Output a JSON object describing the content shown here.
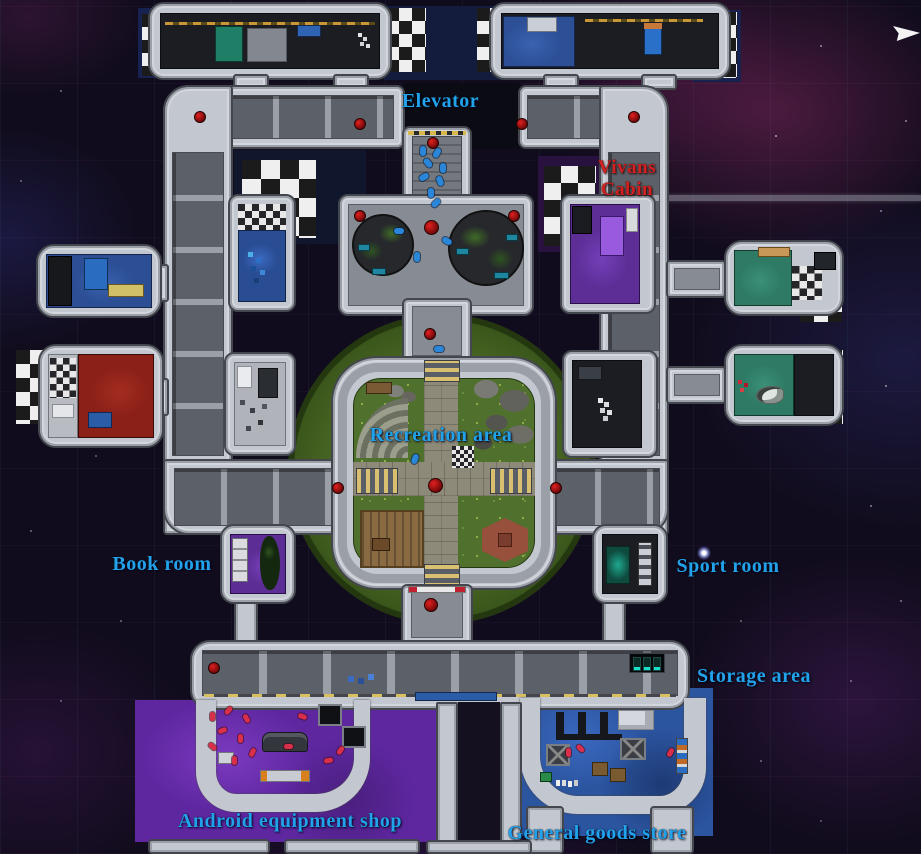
{
  "scene": {
    "description": "Top-down space station map with labeled rooms",
    "cursor_icon": "pointer-arrow-icon"
  },
  "labels": {
    "elevator": {
      "text": "Elevator",
      "color": "#22a2ea"
    },
    "vivans_cabin": {
      "line1": "Vivans",
      "line2": "Cabin",
      "color": "#d42020"
    },
    "recreation_area": {
      "text": "Recreation area",
      "color": "#22a2ea"
    },
    "book_room": {
      "text": "Book room",
      "color": "#22a2ea"
    },
    "sport_room": {
      "text": "Sport room",
      "color": "#22a2ea"
    },
    "storage_area": {
      "text": "Storage area",
      "color": "#22a2ea"
    },
    "android_shop": {
      "text": "Android equipment shop",
      "color": "#22a2ea"
    },
    "general_store": {
      "text": "General goods store",
      "color": "#22a2ea"
    }
  },
  "colors": {
    "label_blue": "#22a2ea",
    "label_red": "#d42020",
    "hull": "#c3c7cf",
    "hull_outline": "#43464c",
    "corridor_floor": "#878c94",
    "panel_gray": "#5c6068",
    "recreation_green": "#3c581c",
    "grass": "#50702e",
    "shop_purple": "#6b2fa6",
    "store_blue": "#2c55a0",
    "cabin_blue": "#2d4f96",
    "room_red": "#8a2018",
    "room_green": "#2e7a64",
    "vivans_purple": "#5c2e96",
    "lamp_red": "#b01818",
    "crew_blue": "#2a86d8",
    "android_pink": "#d8304a",
    "space_bg": "#110c1d"
  }
}
